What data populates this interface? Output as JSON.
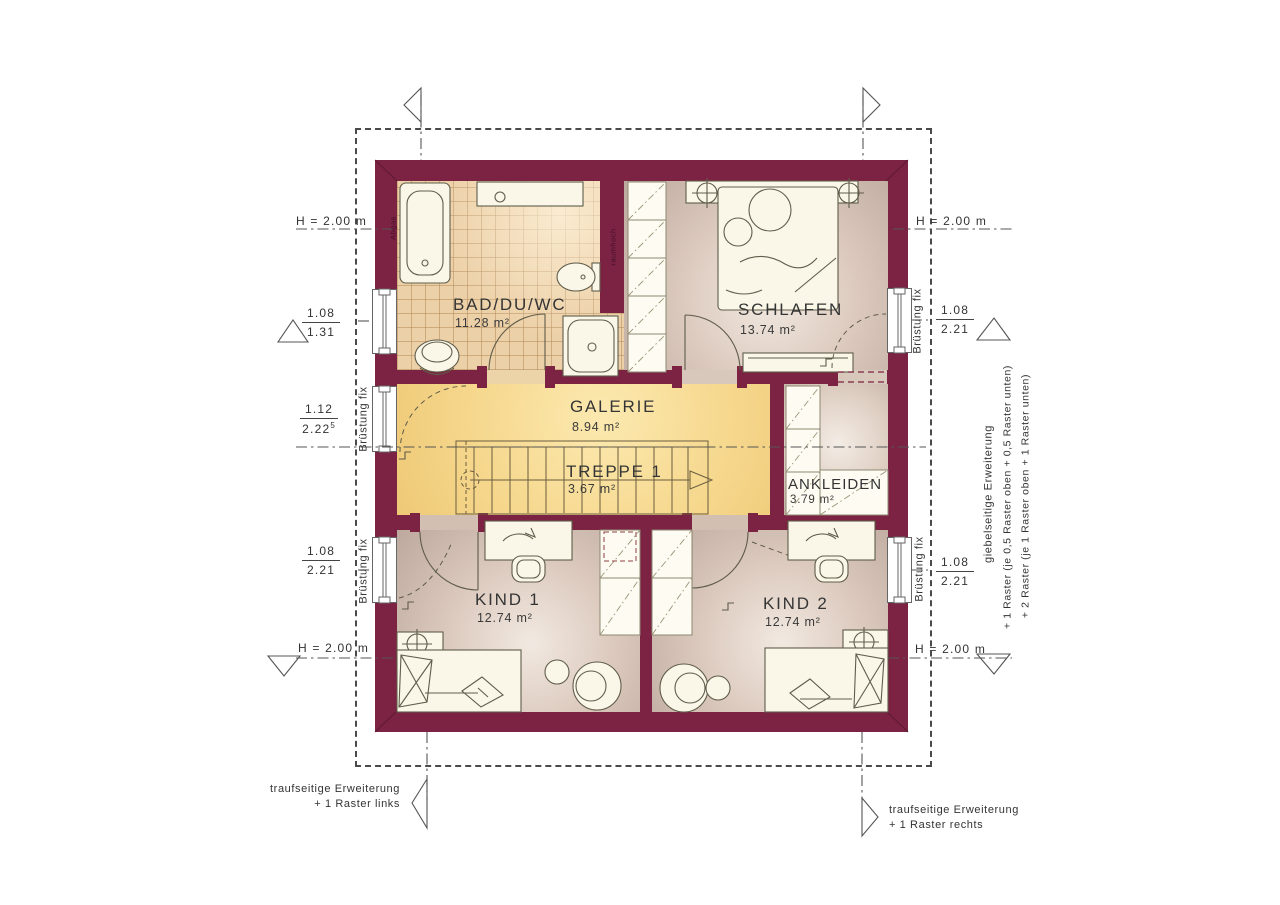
{
  "rooms": {
    "bad": {
      "name": "BAD/DU/WC",
      "area": "11.28 m²"
    },
    "schlafen": {
      "name": "SCHLAFEN",
      "area": "13.74 m²"
    },
    "galerie": {
      "name": "GALERIE",
      "area": "8.94 m²"
    },
    "treppe": {
      "name": "TREPPE 1",
      "area": "3.67 m²"
    },
    "ankleiden": {
      "name": "ANKLEIDEN",
      "area": "3.79 m²"
    },
    "kind1": {
      "name": "KIND 1",
      "area": "12.74 m²"
    },
    "kind2": {
      "name": "KIND 2",
      "area": "12.74 m²"
    }
  },
  "dims": {
    "h_label": "H = 2.00 m",
    "left_top": {
      "num": "1.08",
      "den": "1.31"
    },
    "left_mid": {
      "num": "1.12",
      "den": "2.22",
      "sup": "5"
    },
    "left_bottom": {
      "num": "1.08",
      "den": "2.21"
    },
    "right_top": {
      "num": "1.08",
      "den": "2.21"
    },
    "right_bottom": {
      "num": "1.08",
      "den": "2.21"
    }
  },
  "annotations": {
    "bruestung": "Brüstung fix",
    "abgas": "Abgas",
    "raumhoch": "raumhoch",
    "giebel_line1": "giebelseitige Erweiterung",
    "giebel_line2": "+ 1 Raster (je 0,5 Raster oben + 0,5 Raster unten)",
    "giebel_line3": "+ 2 Raster (je 1 Raster oben + 1 Raster unten)",
    "trauf_left_line1": "traufseitige Erweiterung",
    "trauf_left_line2": "+ 1 Raster links",
    "trauf_right_line1": "traufseitige Erweiterung",
    "trauf_right_line2": "+ 1 Raster rechts"
  },
  "colors": {
    "wall": "#7c2242",
    "galerie_floor": "#f6d88e",
    "tile_floor": "#ecd0a7",
    "room_floor": "#dcc9bd",
    "furniture": "#faf7e8"
  }
}
